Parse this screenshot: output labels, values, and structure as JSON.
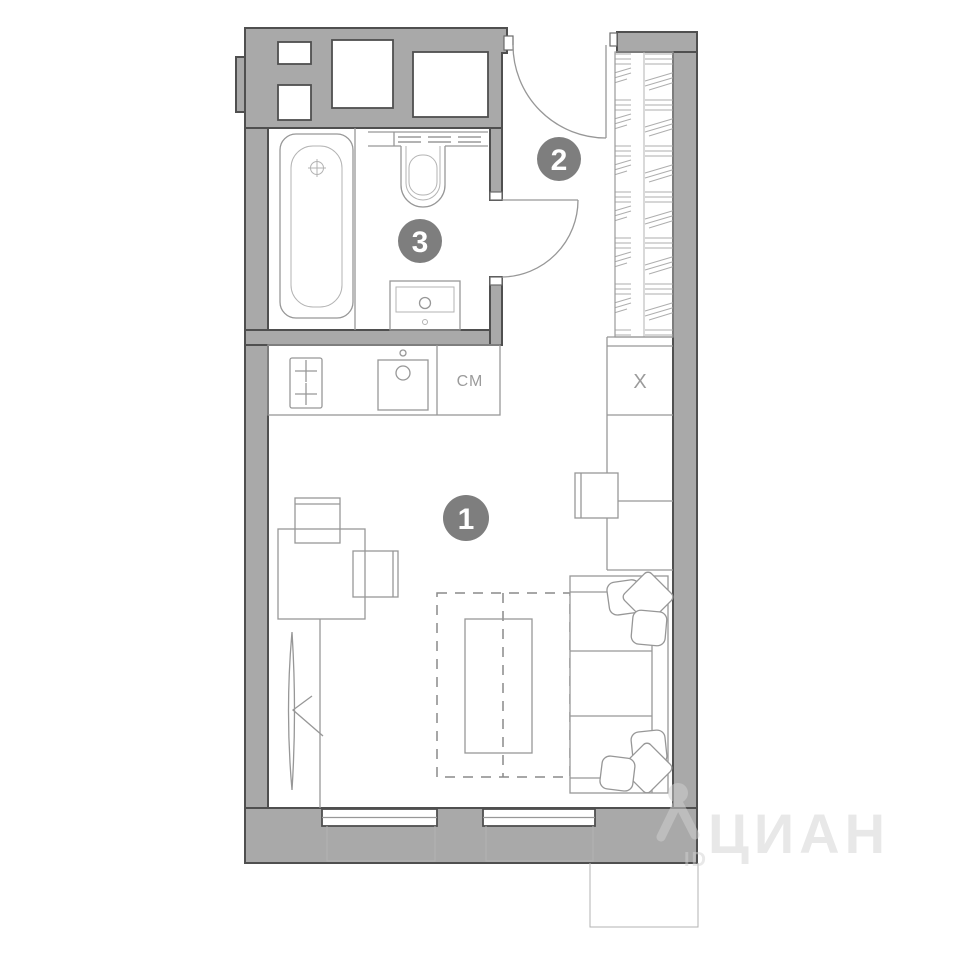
{
  "rooms": {
    "living": {
      "number": "1"
    },
    "hall": {
      "number": "2"
    },
    "bathroom": {
      "number": "3"
    }
  },
  "kitchen": {
    "washing_machine_label": "СМ"
  },
  "storage": {
    "fridge_label": "Х"
  },
  "watermark": {
    "brand": "ЦИАН",
    "id_label": "ID",
    "logo_icon": "person-pin-logo"
  },
  "colors": {
    "wall_fill": "#a9a9a9",
    "wall_stroke": "#4f4f4f",
    "line": "#979797",
    "line_light": "#b3b3b3",
    "badge": "#7e7e7e",
    "label_text": "#9b9b9b",
    "watermark": "#d2d2d2"
  }
}
